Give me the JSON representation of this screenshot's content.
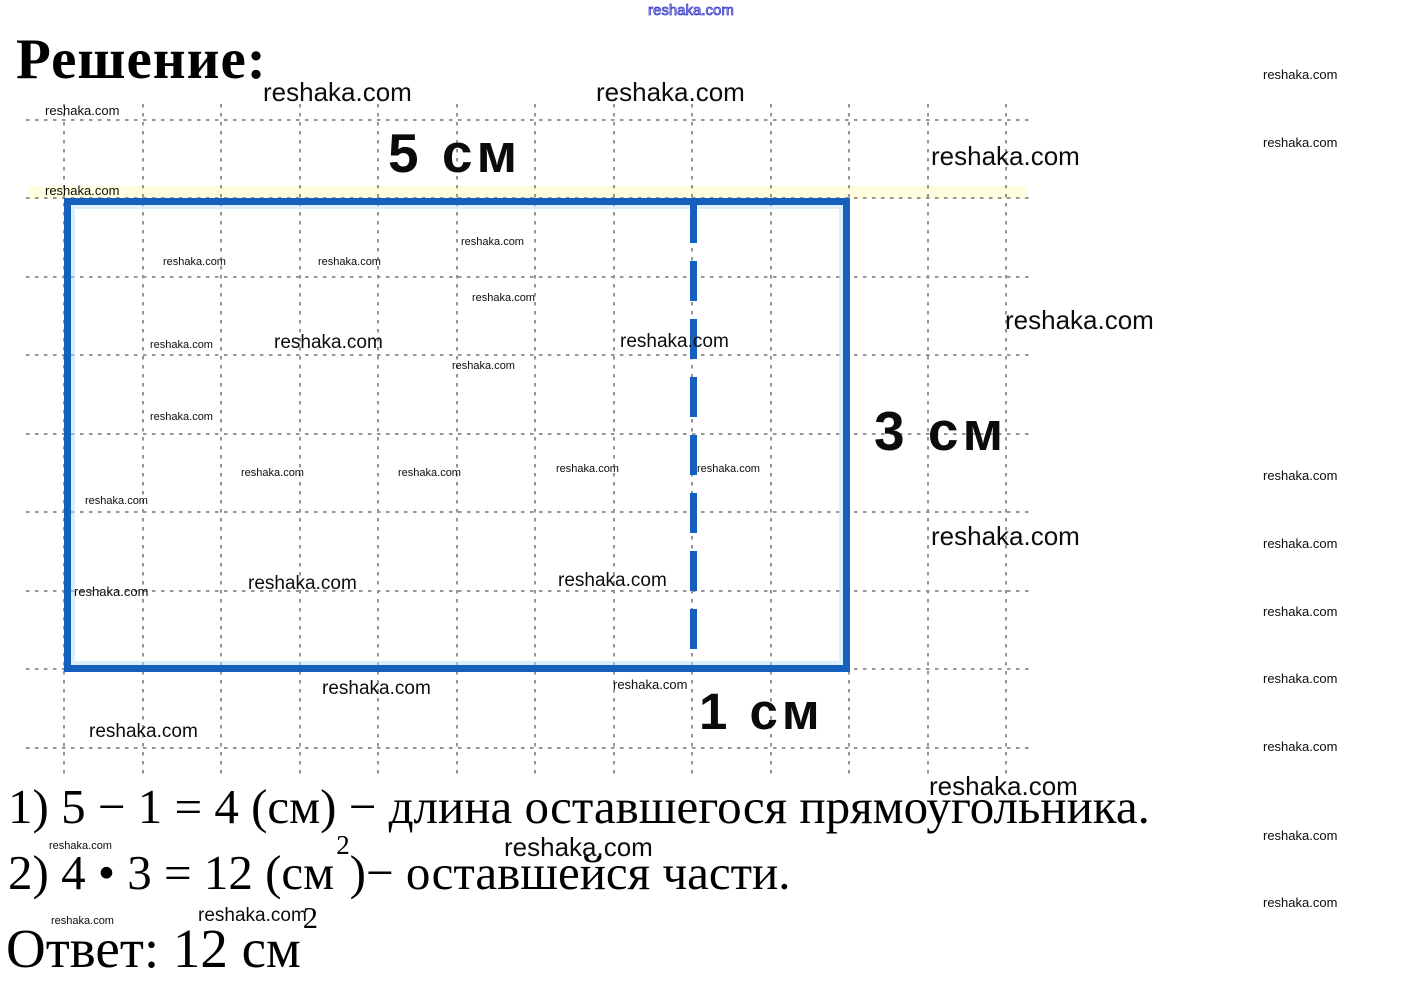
{
  "page_title": "Решение:",
  "watermark_text": "reshaka.com",
  "figure": {
    "width_label": "5 см",
    "height_label": "3 см",
    "cut_label": "1 см",
    "rect_color": "#1660bd",
    "grid_color": "#969696"
  },
  "solution": {
    "step1": "1) 5 − 1 = 4 (см) − длина оставшегося прямоугольника.",
    "step2_before": "2) 4 • 3 = 12 (см",
    "step2_sup": "2",
    "step2_after": ")− оставшейся части.",
    "answer_before": "Ответ: 12 см",
    "answer_sup": "2"
  },
  "watermarks": [
    {
      "x": 648,
      "y": 3,
      "c": "o"
    },
    {
      "x": 263,
      "y": 78,
      "c": "l"
    },
    {
      "x": 596,
      "y": 78,
      "c": "l"
    },
    {
      "x": 45,
      "y": 104,
      "c": "s"
    },
    {
      "x": 1263,
      "y": 68,
      "c": "s"
    },
    {
      "x": 931,
      "y": 142,
      "c": "l"
    },
    {
      "x": 1263,
      "y": 136,
      "c": "s"
    },
    {
      "x": 45,
      "y": 184,
      "c": "s"
    },
    {
      "x": 461,
      "y": 236,
      "c": "t"
    },
    {
      "x": 163,
      "y": 256,
      "c": "t"
    },
    {
      "x": 318,
      "y": 256,
      "c": "t"
    },
    {
      "x": 472,
      "y": 292,
      "c": "t"
    },
    {
      "x": 1005,
      "y": 306,
      "c": "l"
    },
    {
      "x": 150,
      "y": 339,
      "c": "t"
    },
    {
      "x": 274,
      "y": 333,
      "c": "m"
    },
    {
      "x": 620,
      "y": 332,
      "c": "m"
    },
    {
      "x": 452,
      "y": 360,
      "c": "t"
    },
    {
      "x": 150,
      "y": 411,
      "c": "t"
    },
    {
      "x": 241,
      "y": 467,
      "c": "t"
    },
    {
      "x": 398,
      "y": 467,
      "c": "t"
    },
    {
      "x": 556,
      "y": 463,
      "c": "t"
    },
    {
      "x": 697,
      "y": 463,
      "c": "t"
    },
    {
      "x": 1263,
      "y": 469,
      "c": "s"
    },
    {
      "x": 85,
      "y": 495,
      "c": "t"
    },
    {
      "x": 931,
      "y": 522,
      "c": "l"
    },
    {
      "x": 1263,
      "y": 537,
      "c": "s"
    },
    {
      "x": 74,
      "y": 585,
      "c": "s"
    },
    {
      "x": 248,
      "y": 574,
      "c": "m"
    },
    {
      "x": 558,
      "y": 571,
      "c": "m"
    },
    {
      "x": 1263,
      "y": 605,
      "c": "s"
    },
    {
      "x": 322,
      "y": 679,
      "c": "m"
    },
    {
      "x": 613,
      "y": 678,
      "c": "s"
    },
    {
      "x": 1263,
      "y": 672,
      "c": "s"
    },
    {
      "x": 89,
      "y": 722,
      "c": "m"
    },
    {
      "x": 1263,
      "y": 740,
      "c": "s"
    },
    {
      "x": 929,
      "y": 772,
      "c": "l"
    },
    {
      "x": 1263,
      "y": 829,
      "c": "s"
    },
    {
      "x": 49,
      "y": 840,
      "c": "t"
    },
    {
      "x": 504,
      "y": 833,
      "c": "l"
    },
    {
      "x": 198,
      "y": 906,
      "c": "m"
    },
    {
      "x": 1263,
      "y": 896,
      "c": "s"
    },
    {
      "x": 51,
      "y": 915,
      "c": "t"
    }
  ]
}
